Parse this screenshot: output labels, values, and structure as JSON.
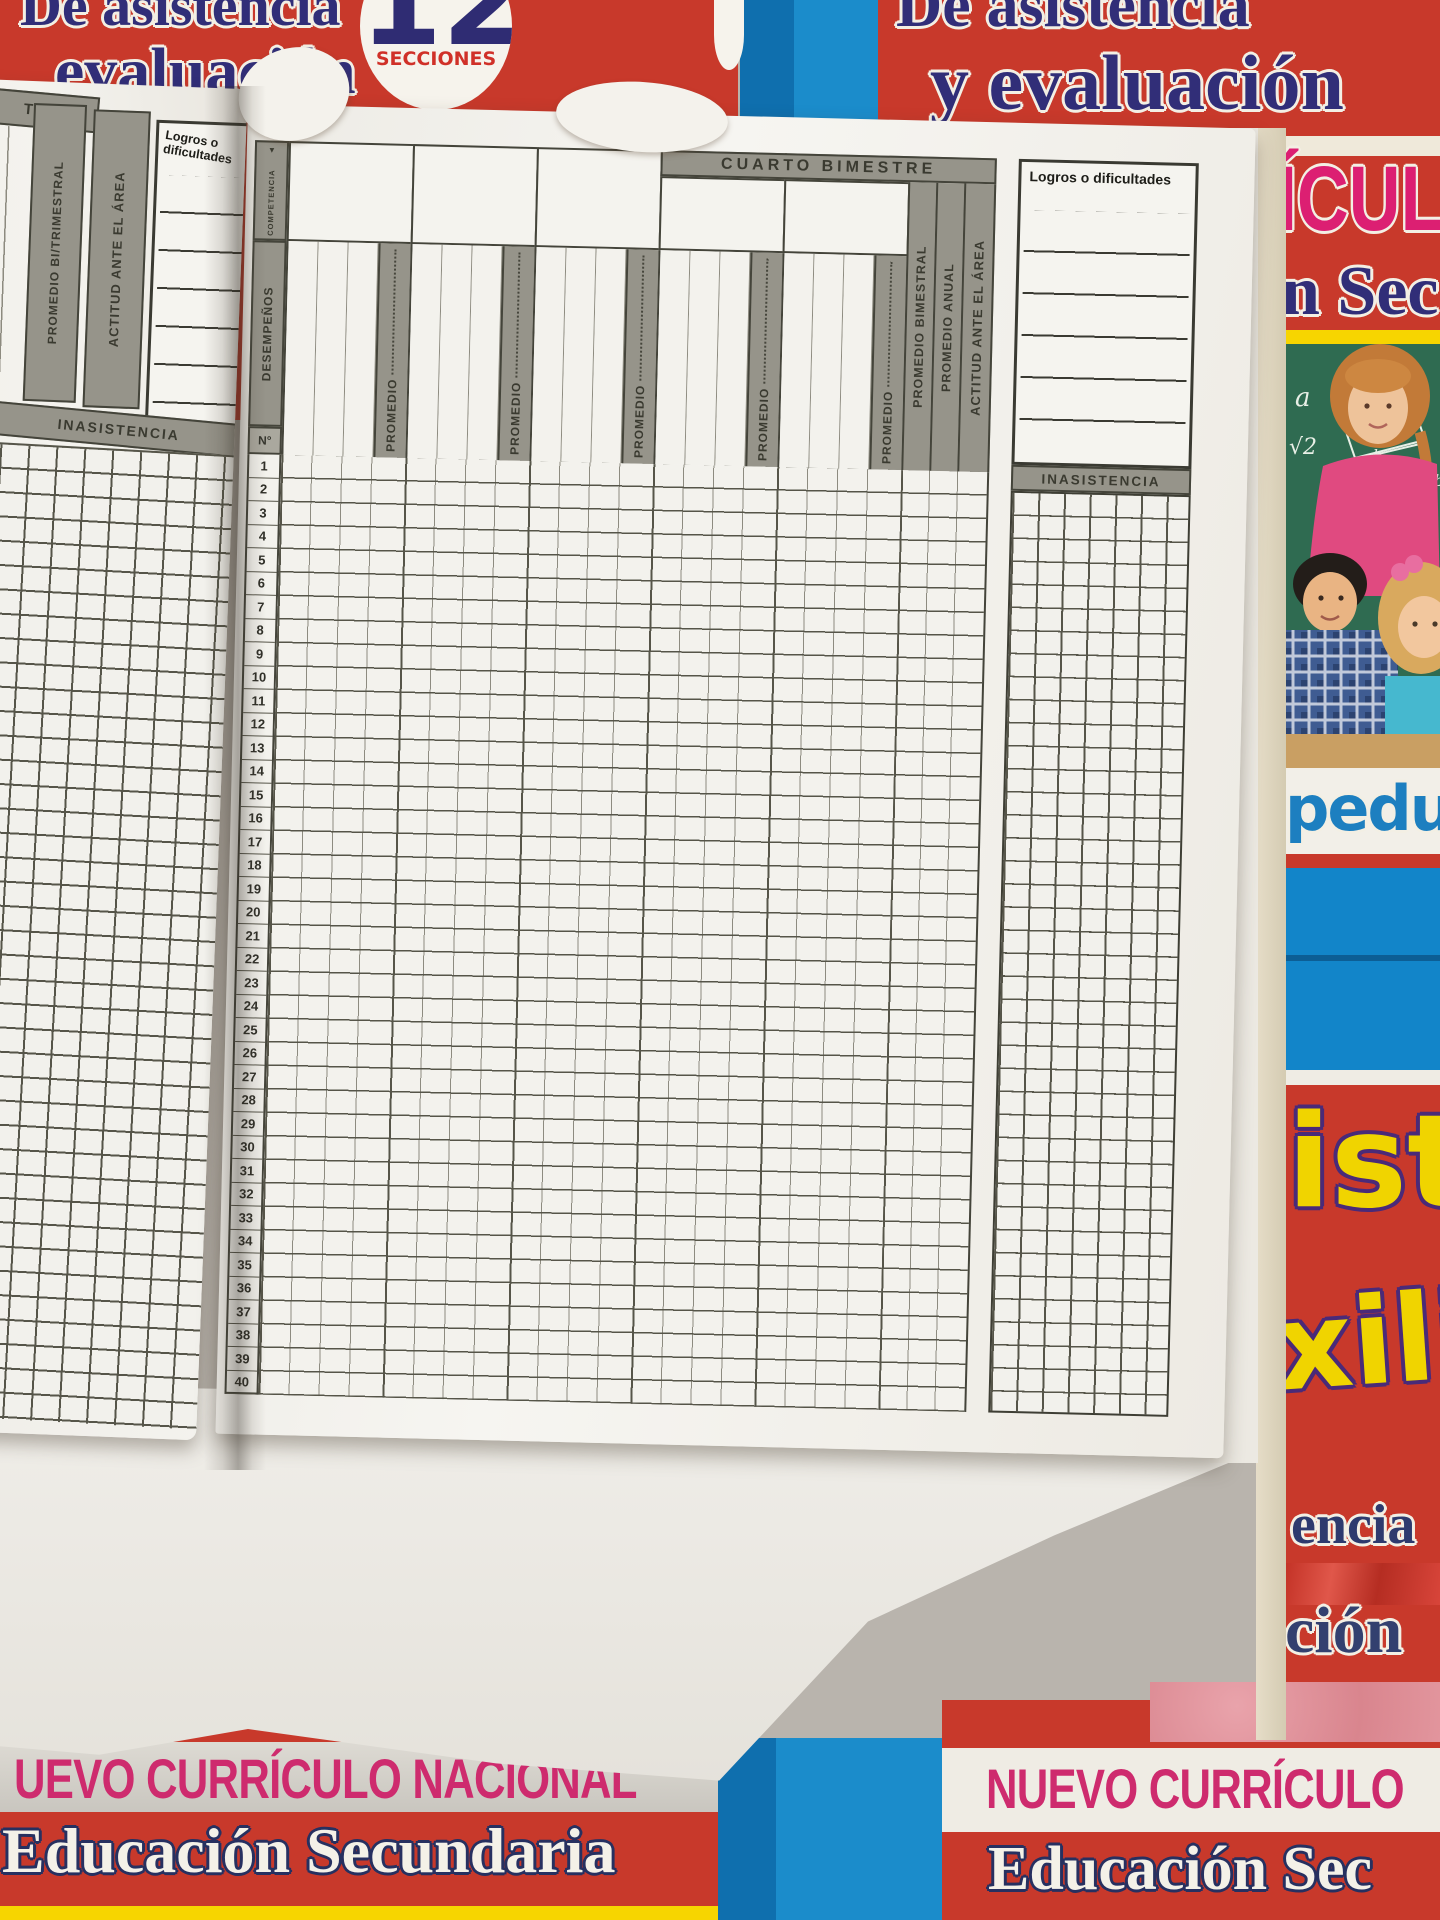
{
  "covers": {
    "top_left": {
      "line1": "De asistencia",
      "line2": "evaluación"
    },
    "badge": {
      "number": "12",
      "label": "SECCIONES"
    },
    "top_right": {
      "line1": "De asistencia",
      "line2": "y evaluación"
    },
    "right_side": {
      "curriculo_fragment": "ÍCULO",
      "secundaria_fragment": "n Sec",
      "chalk_marks": [
        "a",
        "√2",
        "b",
        "m",
        "h",
        "a+b",
        "2"
      ],
      "logo_fragment": "pedu",
      "ist_fragment": "ist",
      "xili_fragment": "xili",
      "encia_fragment": "encia",
      "cion_fragment": "ción"
    },
    "bottom_left": {
      "title_fragment": "UEVO CURRÍCULO NACIONAL",
      "subtitle": "Educación Secundaria"
    },
    "bottom_right": {
      "title_fragment": "NUEVO CURRÍCULO",
      "subtitle_fragment": "Educación Sec"
    }
  },
  "register": {
    "left_page": {
      "band_fragment": "TRE",
      "columns": [
        "PROMEDIO BI/TRIMESTRAL",
        "ACTITUD ANTE EL ÁREA"
      ],
      "logros_label": "Logros o dificultades",
      "inasistencia_label": "INASISTENCIA"
    },
    "right_page": {
      "bimester_title": "CUARTO BIMESTRE",
      "competencia_label": "COMPETENCIA",
      "competencia_arrow": "▼",
      "desempenos_label": "DESEMPEÑOS",
      "numero_label": "N°",
      "promedio_label": "PROMEDIO",
      "summary_columns": [
        "PROMEDIO  BIMESTRAL",
        "PROMEDIO ANUAL",
        "ACTITUD ANTE EL ÁREA"
      ],
      "logros_label": "Logros o dificultades",
      "inasistencia_label": "INASISTENCIA",
      "group_count": 5,
      "row_numbers": [
        1,
        2,
        3,
        4,
        5,
        6,
        7,
        8,
        9,
        10,
        11,
        12,
        13,
        14,
        15,
        16,
        17,
        18,
        19,
        20,
        21,
        22,
        23,
        24,
        25,
        26,
        27,
        28,
        29,
        30,
        31,
        32,
        33,
        34,
        35,
        36,
        37,
        38,
        39,
        40
      ]
    }
  },
  "colors": {
    "cover_red": "#c8392b",
    "cover_navy": "#312e78",
    "badge_red": "#d03028",
    "magenta": "#dc1f72",
    "yellow": "#f2d600",
    "letter_outline_purple": "#4a2a78",
    "blue_panel": "#1285c9",
    "chalkboard_green": "#2f6b51",
    "header_gray": "#96948a",
    "table_line": "#44443a",
    "page_white": "#f3f2ed"
  }
}
